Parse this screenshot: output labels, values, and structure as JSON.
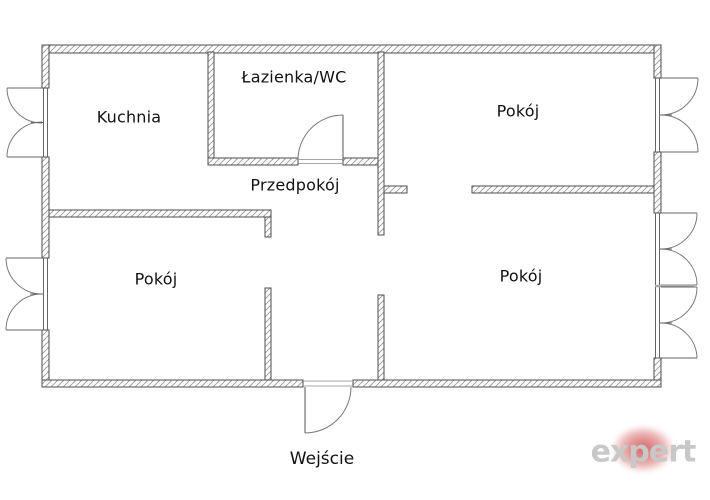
{
  "rooms": [
    {
      "id": "kitchen",
      "label": "Kuchnia"
    },
    {
      "id": "bathroom",
      "label": "Łazienka/WC"
    },
    {
      "id": "room-top-right",
      "label": "Pokój"
    },
    {
      "id": "hallway",
      "label": "Przedpokój"
    },
    {
      "id": "room-bottom-left",
      "label": "Pokój"
    },
    {
      "id": "room-bottom-right",
      "label": "Pokój"
    }
  ],
  "entrance_label": "Wejście",
  "watermark": {
    "text": "expert",
    "text_color": "#c8c8c8",
    "blob_color": "#c93e3e"
  },
  "colors": {
    "background": "#ffffff",
    "wall_outline": "#4d4d4d",
    "wall_hatch": "#9a9a9a",
    "door_arc": "#777777",
    "label_text": "#111111"
  }
}
